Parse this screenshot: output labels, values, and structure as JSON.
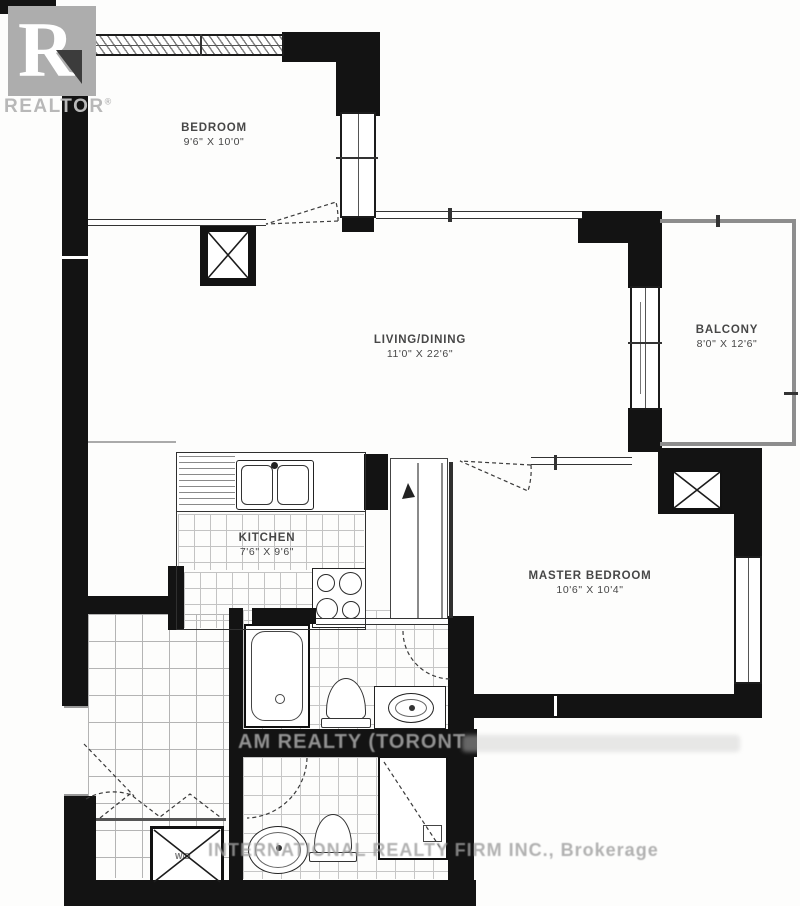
{
  "branding": {
    "logo_letter": "R",
    "logo_name": "REALTOR",
    "logo_reg": "®"
  },
  "rooms": [
    {
      "id": "bedroom",
      "name": "BEDROOM",
      "dims": "9'6\" X 10'0\""
    },
    {
      "id": "living_dining",
      "name": "LIVING/DINING",
      "dims": "11'0\" X 22'6\""
    },
    {
      "id": "balcony",
      "name": "BALCONY",
      "dims": "8'0\" X 12'6\""
    },
    {
      "id": "kitchen",
      "name": "KITCHEN",
      "dims": "7'6\" X 9'6\""
    },
    {
      "id": "master_bedroom",
      "name": "MASTER BEDROOM",
      "dims": "10'6\" X 10'4\""
    }
  ],
  "fixtures": {
    "washer_dryer_label": "W/D"
  },
  "watermarks": {
    "middle": "AM REALTY (TORONT",
    "bottom": "INTERNATIONAL REALTY FIRM INC., Brokerage"
  },
  "colors": {
    "wall": "#131313",
    "logo_gray": "#adadad",
    "watermark_gray": "#9e9e9e",
    "tile_line": "#c3c3c3"
  }
}
